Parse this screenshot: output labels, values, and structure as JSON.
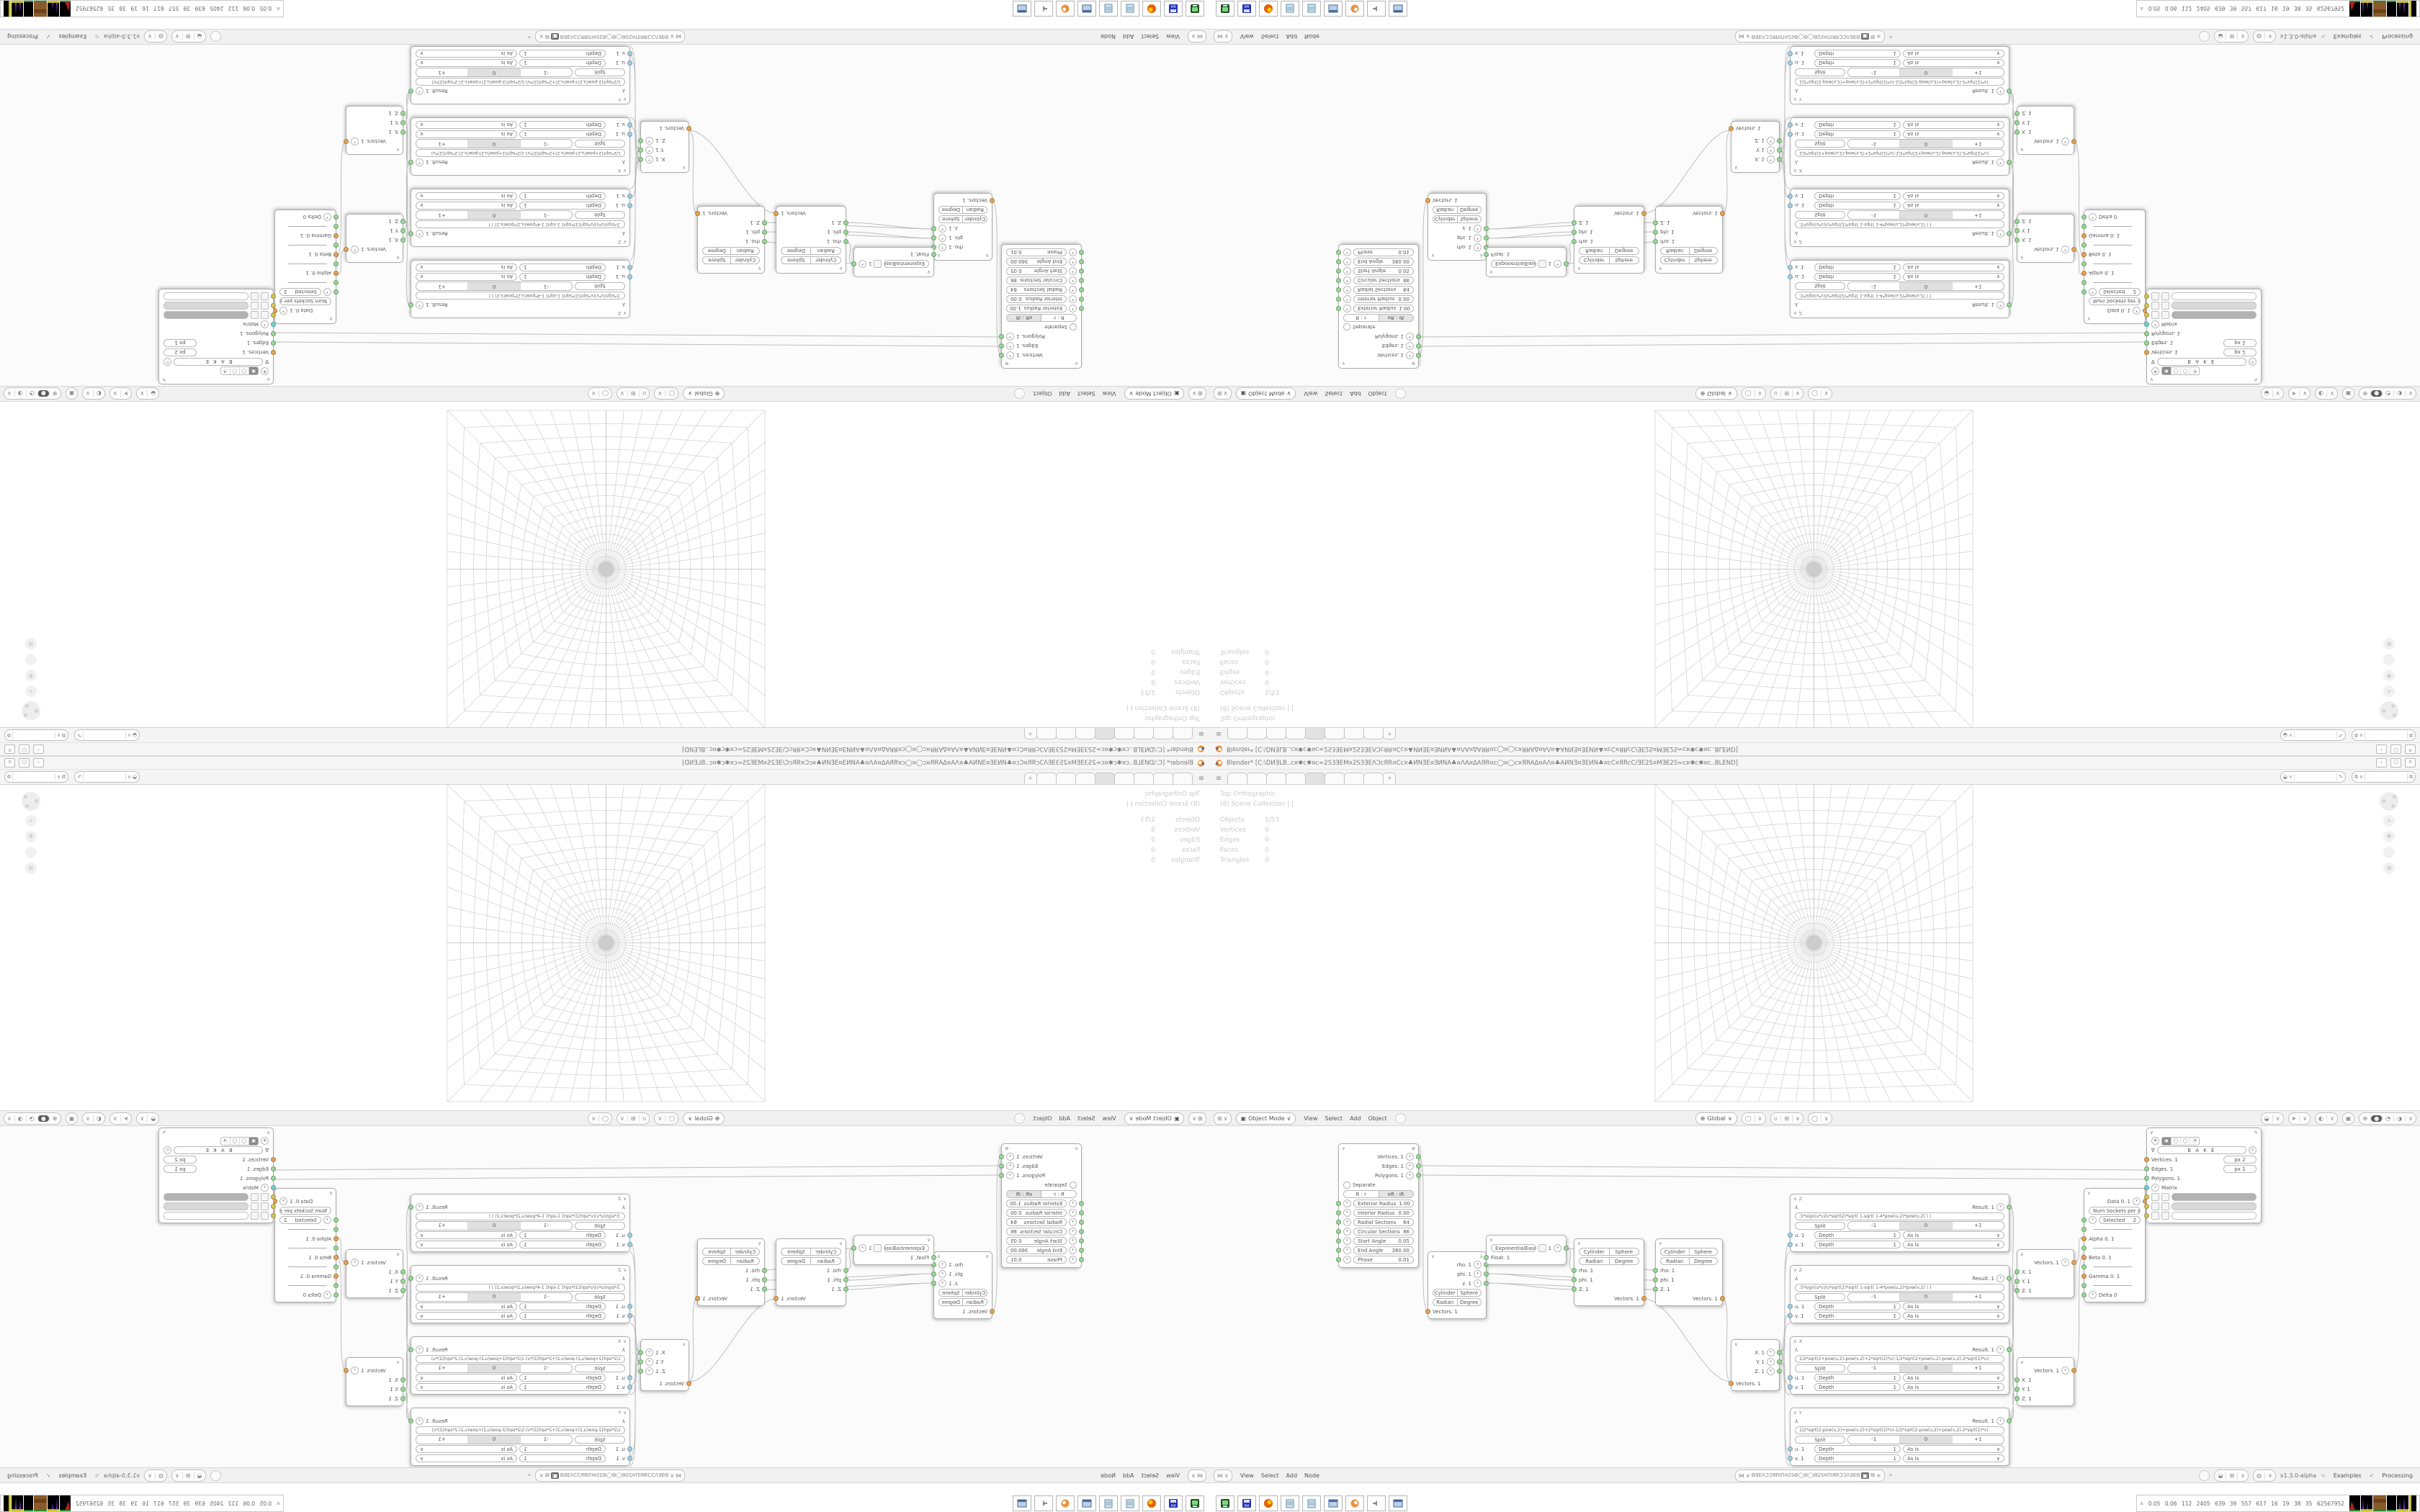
{
  "window": {
    "title": "Blender* [C:\\DИƎLB..ᴄ¤✱ᴄ✱¤ᴄ≈2S3ƎEM¤2S3ƎEΛϽᴄЯR¤Ϲᴄ¤♣ИNƎE¤ƎИNA♣¤ΛA¤ΔAЯR¤ᴄ◯¤◯ᴄ¤ЯRAΔ¤AΛ¤♣AИNƎ¤ƎEИN♣¤ᴄϹ¤ЯRᴄϹ/ƎE2S¤MƎE2S≈ᴄ¤✱ᴄ✱¤ᴄ..BLEND]",
    "minimize": "–",
    "maximize": "▢",
    "close": "×"
  },
  "icons": {
    "menu": "≡",
    "chevron_down": "∨",
    "chevron_up": "∧",
    "dropdown": "▾",
    "close": "×",
    "check": "✓",
    "sverchok": "⋈",
    "plus": "+",
    "examples_dna": "∿",
    "pencil": "✎",
    "pin": "⌖",
    "gear": "⊛",
    "bake_tri": "∇",
    "circle": "◯",
    "sphere_solid": "●",
    "sphere_quarter": "◔",
    "sphere_half": "◑",
    "globe": "⊕",
    "xray": "▣",
    "magnet": "∪",
    "cursor": "➤",
    "brush": "◒",
    "hand": "✥",
    "ortho": "⊞",
    "formula": "⅄",
    "stats_up": "⩓",
    "orb": "◐",
    "person": "◒",
    "grid": "⊞",
    "ball": "◍",
    "shield": "⛨",
    "copy": "⧉"
  },
  "topbar": {
    "tab_labels": [
      "",
      "",
      "",
      "",
      "",
      "",
      "",
      ""
    ],
    "active_tab_index": 4
  },
  "viewport": {
    "overlay": {
      "view": "Top Orthographic",
      "collection": "(8) Scene Collection | |",
      "rows": [
        [
          "Objects",
          "1/53"
        ],
        [
          "Vertices",
          "0"
        ],
        [
          "Edges",
          "0"
        ],
        [
          "Faces",
          "0"
        ],
        [
          "Triangles",
          "0"
        ]
      ]
    },
    "header": {
      "mode": "Object Mode",
      "menus": [
        "View",
        "Select",
        "Add",
        "Object"
      ],
      "orientation": "Global"
    }
  },
  "node_editor": {
    "header": {
      "menus": [
        "View",
        "Select",
        "Add",
        "Node"
      ],
      "tree_name": "ΘƎEΛϽϽЯRIΠ¤2SΘ◯Θ◯Θ2S¤ΠIЯRϽϽΛƎEΘ",
      "version": "v1.3.0-alpha",
      "examples": "Examples",
      "processing": "Processing"
    },
    "torus": {
      "outputs": [
        "Vertices. 1",
        "Edges. 1",
        "Polygons. 1"
      ],
      "separate": "Separate",
      "mode_a": "R : r",
      "mode_b": "eR : iR",
      "params": [
        [
          "Exterior Radius",
          "1.00"
        ],
        [
          "Interior Radius",
          "0.00"
        ],
        [
          "Radial Sections",
          "64"
        ],
        [
          "Circular Sections",
          "86"
        ],
        [
          "Start Angle",
          "0.05"
        ],
        [
          "End Angle",
          "360.00"
        ],
        [
          "Phase",
          "0.01"
        ]
      ]
    },
    "polar_out": {
      "outs": [
        "rho. 1",
        "phi. 1",
        "z. 1"
      ],
      "t1a": "Cylinder",
      "t1b": "Sphere",
      "t2a": "Radian",
      "t2b": "Degree",
      "input": "Vectors. 1"
    },
    "easing": {
      "preset": "ExponentialEaseIn",
      "value": "1",
      "input": "Float. 1"
    },
    "polar_in": {
      "t1a": "Cylinder",
      "t1b": "Sphere",
      "t2a": "Radian",
      "t2b": "Degree",
      "ins": [
        "rho. 1",
        "phi. 1",
        "Z. 1"
      ],
      "out": "Vectors. 1"
    },
    "vector_out": {
      "outs": [
        "X. 1",
        "Y. 1",
        "Z. 1"
      ],
      "input": "Vectors. 1"
    },
    "formula_shared": {
      "result": "Result. 1",
      "split": "Split",
      "neg": "-1",
      "zero": "0",
      "pos": "+1",
      "u": "u. 1",
      "v": "v. 1",
      "depth": "Depth",
      "depth_val": "1",
      "asis": "As is"
    },
    "formulas": [
      {
        "title": "Z",
        "formula": ".5*sign(u*v)/v*sqrt(2)*sqrt( 1-sqrt( 1-4*pow(u,2)*pow(v,2) ) )"
      },
      {
        "title": "Z",
        "formula": ".5*sign(u*v)/u*sqrt(2)*sqrt( 1-sqrt( 1-4*pow(u,2)*pow(v,2) ) )"
      },
      {
        "title": "X",
        "formula": "1/2*sqrt(2+pow(u,2)-pow(v,2)+2*sqrt(2)*u)-1/2*sqrt(2+pow(u,2)-pow(v,2)-2*sqrt(2)*u)"
      },
      {
        "title": "Y",
        "formula": "1/2*sqrt(2-pow(u,2)+pow(v,2)+2*sqrt(2)*v)-1/2*sqrt(2-pow(u,2)+pow(v,2)-2*sqrt(2)*v)"
      }
    ],
    "vector_in": {
      "out": "Vectors. 1",
      "ins": [
        "X. 1",
        "Y. 1",
        "Z. 1"
      ]
    },
    "switch": {
      "out": "Data 0. 1",
      "num_sockets_label": "Num Sockets per set",
      "num_sockets_val": "1",
      "selected_label": "Selected",
      "selected_val": "2",
      "slots": [
        "Alpha 0. 1",
        "Beta 0. 1",
        "Gamma 0. 1"
      ],
      "last": "Delta 0"
    },
    "viewer": {
      "bake": "B A K E",
      "rows": [
        {
          "label": "Vertices. 1",
          "pill": "px   2"
        },
        {
          "label": "Edges. 1",
          "pill": "px   1"
        },
        {
          "label": "Polygons. 1",
          "pill": ""
        },
        {
          "label": "Matrix",
          "pill": ""
        }
      ],
      "swatches": [
        "#b2b2b2",
        "#d8d8d8",
        "#ffffff"
      ]
    }
  },
  "taskbar": {
    "stats": "0.05 0.06  112 2405 639  39  557 617  16  19  38  35  62567952",
    "icon_names": [
      "drive-icon",
      "floppy64-icon",
      "firefox-icon",
      "notepad-icon",
      "notepad-icon",
      "window-icon",
      "blender-icon",
      "speaker-icon",
      "window-icon"
    ]
  },
  "colors": {
    "accent_orange": "#e8913c",
    "socket_green": "#9ed69b",
    "socket_orange": "#e2a45f",
    "socket_cyan": "#7ccfcf",
    "socket_blue": "#a9cede",
    "socket_yellow": "#d8c35e",
    "grid_line": "#d4d4d4",
    "wire": "#bdbdbd"
  }
}
